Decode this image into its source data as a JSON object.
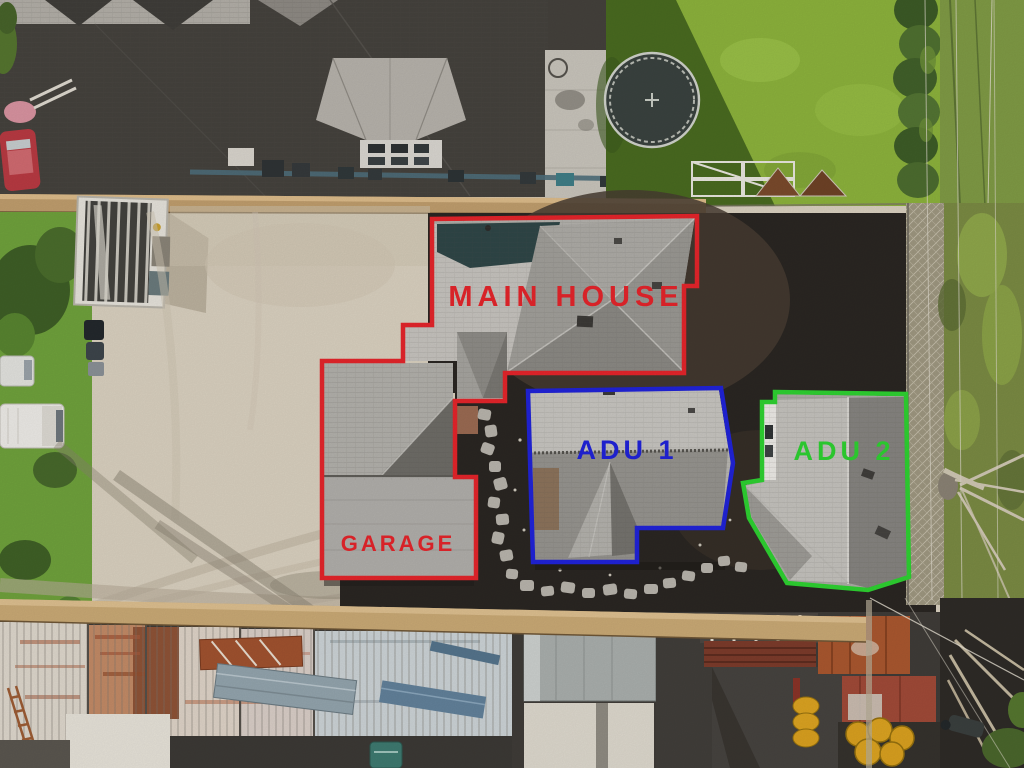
{
  "annotations": {
    "main_house": {
      "label": "MAIN HOUSE",
      "color": "#e4252b"
    },
    "garage": {
      "label": "GARAGE",
      "color": "#e4252b"
    },
    "adu_1": {
      "label": "ADU 1",
      "color": "#2023d8"
    },
    "adu_2": {
      "label": "ADU 2",
      "color": "#2ed131"
    }
  }
}
